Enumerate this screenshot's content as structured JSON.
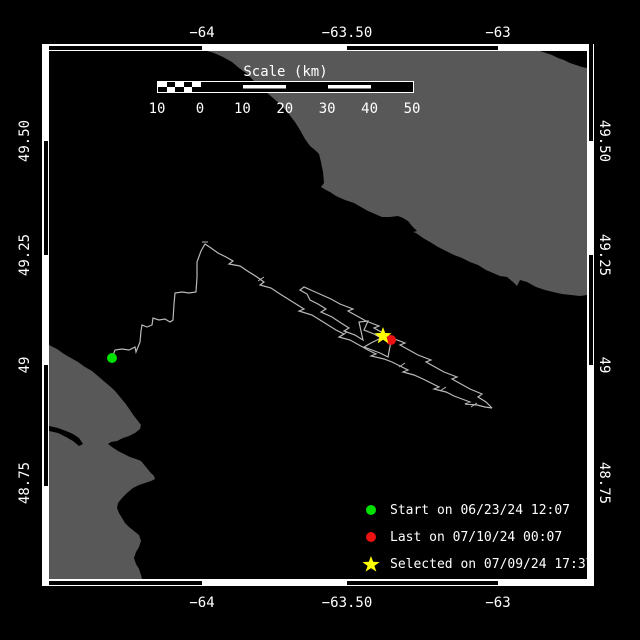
{
  "map": {
    "colors": {
      "sea": "#000000",
      "land": "#585858",
      "track": "#b9b9b9",
      "frame": "#ffffff",
      "start_marker": "#00e100",
      "last_marker": "#ee1111",
      "selected_marker": "#ffff00"
    },
    "land_polygons": [
      [
        [
          207,
          51
        ],
        [
          540,
          51
        ],
        [
          546,
          53
        ],
        [
          552,
          55
        ],
        [
          558,
          58
        ],
        [
          564,
          60
        ],
        [
          570,
          63
        ],
        [
          576,
          65
        ],
        [
          582,
          67
        ],
        [
          587,
          68
        ],
        [
          587,
          295
        ],
        [
          580,
          296
        ],
        [
          571,
          295
        ],
        [
          562,
          294
        ],
        [
          553,
          292
        ],
        [
          545,
          290
        ],
        [
          536,
          287
        ],
        [
          527,
          282
        ],
        [
          520,
          280
        ],
        [
          517,
          286
        ],
        [
          513,
          282
        ],
        [
          507,
          277
        ],
        [
          500,
          276
        ],
        [
          493,
          273
        ],
        [
          486,
          270
        ],
        [
          478,
          265
        ],
        [
          470,
          262
        ],
        [
          462,
          258
        ],
        [
          454,
          255
        ],
        [
          446,
          251
        ],
        [
          438,
          247
        ],
        [
          430,
          242
        ],
        [
          423,
          238
        ],
        [
          416,
          233
        ],
        [
          413,
          232
        ],
        [
          417,
          231
        ],
        [
          412,
          226
        ],
        [
          408,
          221
        ],
        [
          403,
          218
        ],
        [
          398,
          216
        ],
        [
          390,
          217
        ],
        [
          382,
          217
        ],
        [
          375,
          214
        ],
        [
          368,
          211
        ],
        [
          361,
          207
        ],
        [
          354,
          203
        ],
        [
          345,
          200
        ],
        [
          336,
          196
        ],
        [
          330,
          192
        ],
        [
          326,
          190
        ],
        [
          321,
          187
        ],
        [
          324,
          183
        ],
        [
          323,
          172
        ],
        [
          321,
          162
        ],
        [
          319,
          154
        ],
        [
          315,
          150
        ],
        [
          310,
          146
        ],
        [
          305,
          139
        ],
        [
          300,
          130
        ],
        [
          295,
          122
        ],
        [
          288,
          113
        ],
        [
          281,
          105
        ],
        [
          273,
          98
        ],
        [
          265,
          91
        ],
        [
          259,
          86
        ],
        [
          252,
          79
        ],
        [
          246,
          73
        ],
        [
          239,
          68
        ],
        [
          232,
          62
        ],
        [
          223,
          57
        ],
        [
          214,
          53
        ]
      ],
      [
        [
          49,
          345
        ],
        [
          57,
          349
        ],
        [
          64,
          354
        ],
        [
          71,
          358
        ],
        [
          78,
          362
        ],
        [
          85,
          367
        ],
        [
          92,
          371
        ],
        [
          99,
          377
        ],
        [
          106,
          383
        ],
        [
          112,
          388
        ],
        [
          116,
          392
        ],
        [
          120,
          397
        ],
        [
          125,
          403
        ],
        [
          130,
          410
        ],
        [
          134,
          416
        ],
        [
          138,
          421
        ],
        [
          141,
          425
        ],
        [
          140,
          429
        ],
        [
          135,
          433
        ],
        [
          129,
          436
        ],
        [
          123,
          438
        ],
        [
          117,
          441
        ],
        [
          111,
          442
        ],
        [
          108,
          444
        ],
        [
          112,
          447
        ],
        [
          118,
          451
        ],
        [
          124,
          454
        ],
        [
          130,
          457
        ],
        [
          136,
          459
        ],
        [
          141,
          461
        ],
        [
          146,
          467
        ],
        [
          150,
          472
        ],
        [
          154,
          476
        ],
        [
          155,
          479
        ],
        [
          151,
          481
        ],
        [
          145,
          483
        ],
        [
          139,
          485
        ],
        [
          133,
          488
        ],
        [
          127,
          493
        ],
        [
          122,
          498
        ],
        [
          118,
          503
        ],
        [
          117,
          508
        ],
        [
          119,
          513
        ],
        [
          122,
          518
        ],
        [
          125,
          523
        ],
        [
          129,
          527
        ],
        [
          134,
          531
        ],
        [
          139,
          535
        ],
        [
          141,
          541
        ],
        [
          139,
          547
        ],
        [
          136,
          552
        ],
        [
          134,
          558
        ],
        [
          136,
          564
        ],
        [
          139,
          569
        ],
        [
          141,
          575
        ],
        [
          142,
          579
        ],
        [
          49,
          579
        ]
      ]
    ],
    "water_overlays": [
      [
        [
          49,
          426
        ],
        [
          58,
          428
        ],
        [
          66,
          431
        ],
        [
          73,
          434
        ],
        [
          79,
          438
        ],
        [
          83,
          444
        ],
        [
          79,
          446
        ],
        [
          73,
          441
        ],
        [
          66,
          437
        ],
        [
          58,
          433
        ],
        [
          49,
          431
        ]
      ]
    ],
    "track_lines": [
      [
        [
          112,
          358
        ],
        [
          115,
          350
        ],
        [
          122,
          349
        ],
        [
          129,
          350
        ],
        [
          135,
          347
        ],
        [
          136,
          352
        ],
        [
          138,
          347
        ],
        [
          140,
          342
        ],
        [
          141,
          331
        ],
        [
          142,
          325
        ],
        [
          147,
          327
        ],
        [
          152,
          325
        ],
        [
          153,
          318
        ],
        [
          159,
          320
        ],
        [
          165,
          319
        ],
        [
          170,
          322
        ],
        [
          173,
          320
        ],
        [
          174,
          304
        ],
        [
          175,
          293
        ],
        [
          182,
          292
        ],
        [
          189,
          293
        ],
        [
          196,
          292
        ],
        [
          197,
          277
        ],
        [
          197,
          262
        ],
        [
          201,
          251
        ],
        [
          205,
          244
        ],
        [
          211,
          248
        ],
        [
          218,
          253
        ],
        [
          226,
          257
        ],
        [
          233,
          261
        ],
        [
          229,
          264
        ],
        [
          240,
          266
        ],
        [
          249,
          272
        ],
        [
          257,
          277
        ],
        [
          264,
          282
        ],
        [
          260,
          285
        ],
        [
          271,
          288
        ],
        [
          280,
          294
        ],
        [
          288,
          299
        ],
        [
          296,
          304
        ],
        [
          304,
          309
        ],
        [
          299,
          311
        ],
        [
          312,
          315
        ],
        [
          320,
          320
        ],
        [
          328,
          325
        ],
        [
          336,
          330
        ],
        [
          344,
          334
        ],
        [
          339,
          337
        ],
        [
          350,
          340
        ],
        [
          359,
          345
        ],
        [
          368,
          350
        ],
        [
          376,
          354
        ],
        [
          371,
          356
        ],
        [
          384,
          359
        ],
        [
          392,
          362
        ],
        [
          400,
          366
        ],
        [
          408,
          370
        ],
        [
          403,
          372
        ],
        [
          414,
          375
        ],
        [
          423,
          379
        ],
        [
          431,
          383
        ],
        [
          439,
          387
        ],
        [
          434,
          389
        ],
        [
          446,
          392
        ],
        [
          454,
          396
        ],
        [
          462,
          399
        ],
        [
          470,
          402
        ],
        [
          465,
          404
        ],
        [
          477,
          405
        ],
        [
          485,
          407
        ],
        [
          492,
          408
        ]
      ],
      [
        [
          492,
          408
        ],
        [
          486,
          402
        ],
        [
          478,
          397
        ],
        [
          482,
          394
        ],
        [
          470,
          389
        ],
        [
          461,
          384
        ],
        [
          452,
          379
        ],
        [
          457,
          377
        ],
        [
          444,
          372
        ],
        [
          435,
          367
        ],
        [
          426,
          362
        ],
        [
          431,
          360
        ],
        [
          418,
          355
        ],
        [
          409,
          350
        ],
        [
          400,
          345
        ],
        [
          405,
          343
        ],
        [
          392,
          338
        ],
        [
          383,
          333
        ],
        [
          374,
          328
        ],
        [
          379,
          326
        ],
        [
          366,
          321
        ],
        [
          357,
          316
        ],
        [
          348,
          311
        ],
        [
          353,
          309
        ],
        [
          340,
          304
        ],
        [
          331,
          299
        ],
        [
          322,
          295
        ],
        [
          313,
          291
        ],
        [
          304,
          287
        ],
        [
          300,
          290
        ],
        [
          307,
          294
        ],
        [
          310,
          300
        ],
        [
          318,
          304
        ],
        [
          326,
          309
        ],
        [
          321,
          312
        ],
        [
          332,
          317
        ],
        [
          341,
          323
        ],
        [
          349,
          328
        ],
        [
          344,
          331
        ],
        [
          355,
          335
        ],
        [
          363,
          340
        ],
        [
          359,
          322
        ],
        [
          368,
          321
        ],
        [
          364,
          330
        ],
        [
          374,
          334
        ],
        [
          381,
          338
        ],
        [
          371,
          343
        ],
        [
          364,
          347
        ],
        [
          372,
          350
        ],
        [
          380,
          353
        ],
        [
          388,
          357
        ],
        [
          391,
          341
        ]
      ]
    ],
    "tick_spurs": [
      [
        [
          202,
          242
        ],
        [
          208,
          242
        ]
      ],
      [
        [
          258,
          281
        ],
        [
          264,
          277
        ]
      ],
      [
        [
          341,
          336
        ],
        [
          347,
          332
        ]
      ],
      [
        [
          399,
          367
        ],
        [
          405,
          363
        ]
      ],
      [
        [
          440,
          391
        ],
        [
          446,
          387
        ]
      ],
      [
        [
          471,
          407
        ],
        [
          477,
          403
        ]
      ]
    ],
    "markers": {
      "start": {
        "x": 112,
        "y": 358,
        "r": 5
      },
      "last": {
        "x": 391,
        "y": 340,
        "r": 5
      },
      "selected": {
        "x": 383,
        "y": 336,
        "r": 9
      }
    }
  },
  "axes": {
    "top": [
      {
        "text": "−64",
        "x": 202
      },
      {
        "text": "−63.50",
        "x": 347
      },
      {
        "text": "−63",
        "x": 498
      }
    ],
    "bottom": [
      {
        "text": "−64",
        "x": 202
      },
      {
        "text": "−63.50",
        "x": 347
      },
      {
        "text": "−63",
        "x": 498
      }
    ],
    "left": [
      {
        "text": "49.50",
        "y": 141
      },
      {
        "text": "49.25",
        "y": 255
      },
      {
        "text": "49",
        "y": 365
      },
      {
        "text": "48.75",
        "y": 483
      }
    ],
    "right": [
      {
        "text": "49.50",
        "y": 141
      },
      {
        "text": "49.25",
        "y": 255
      },
      {
        "text": "49",
        "y": 365
      },
      {
        "text": "48.75",
        "y": 483
      }
    ]
  },
  "scale_bar": {
    "title": "Scale (km)",
    "tick_labels": [
      "10",
      "0",
      "10",
      "20",
      "30",
      "40",
      "50"
    ],
    "tick_px": [
      0,
      43,
      85.4,
      127.8,
      170.2,
      212.6,
      255
    ]
  },
  "legend": {
    "items": [
      {
        "marker": "circle",
        "color": "#00e100",
        "label": "Start on 06/23/24 12:07"
      },
      {
        "marker": "circle",
        "color": "#ee1111",
        "label": "Last on 07/10/24 00:07"
      },
      {
        "marker": "star",
        "color": "#ffff00",
        "label": "Selected on 07/09/24 17:37"
      }
    ]
  }
}
